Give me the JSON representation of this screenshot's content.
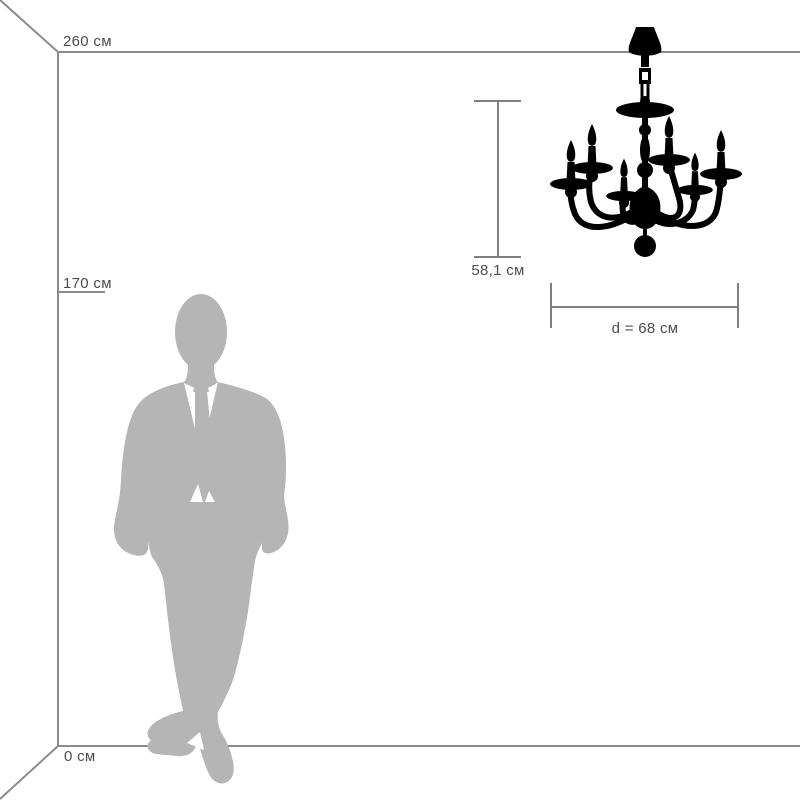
{
  "diagram": {
    "scale_labels": {
      "ceiling": "260 см",
      "person": "170 см",
      "floor": "0 см"
    },
    "dimensions": {
      "height": "58,1 см",
      "diameter": "d = 68 см"
    },
    "figures": {
      "person": "man-silhouette",
      "fixture": "chandelier-silhouette"
    },
    "colors": {
      "room_lines": "#8c8c8c",
      "dimension_lines": "#7f7f7f",
      "label_text": "#4d4d4d",
      "person_fill": "#b5b5b5",
      "fixture_fill": "#000000",
      "background": "#ffffff"
    }
  }
}
